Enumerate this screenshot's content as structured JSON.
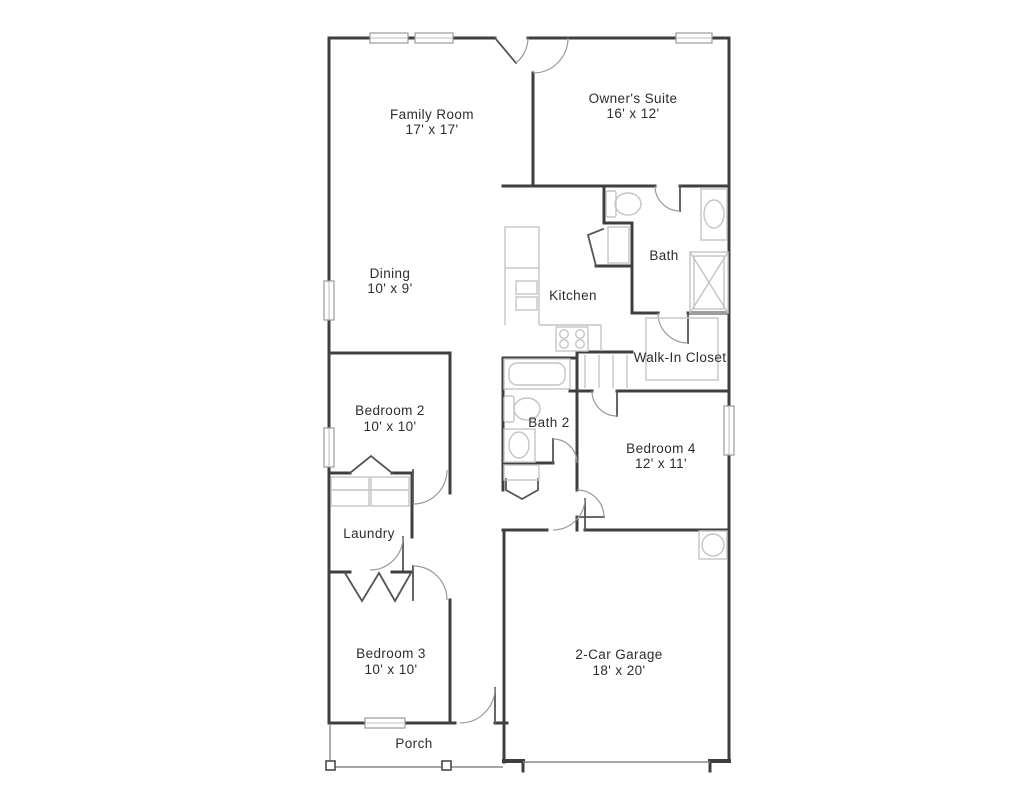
{
  "title": "Floor plan",
  "colors": {
    "background": "#ffffff",
    "wall": "#3f3f3f",
    "fixture": "#c4c4c4",
    "door_arc": "#9a9a9a",
    "text": "#2d2d2d"
  },
  "rooms": [
    {
      "id": "family-room",
      "name": "Family Room",
      "dims": "17' x 17'"
    },
    {
      "id": "owners-suite",
      "name": "Owner's Suite",
      "dims": "16' x 12'"
    },
    {
      "id": "dining",
      "name": "Dining",
      "dims": "10' x 9'"
    },
    {
      "id": "kitchen",
      "name": "Kitchen",
      "dims": ""
    },
    {
      "id": "bath",
      "name": "Bath",
      "dims": ""
    },
    {
      "id": "walk-in-closet",
      "name": "Walk-In Closet",
      "dims": ""
    },
    {
      "id": "bedroom-2",
      "name": "Bedroom 2",
      "dims": "10' x 10'"
    },
    {
      "id": "bath-2",
      "name": "Bath 2",
      "dims": ""
    },
    {
      "id": "bedroom-4",
      "name": "Bedroom 4",
      "dims": "12' x 11'"
    },
    {
      "id": "laundry",
      "name": "Laundry",
      "dims": ""
    },
    {
      "id": "bedroom-3",
      "name": "Bedroom 3",
      "dims": "10' x 10'"
    },
    {
      "id": "garage",
      "name": "2-Car Garage",
      "dims": "18' x 20'"
    },
    {
      "id": "porch",
      "name": "Porch",
      "dims": ""
    }
  ],
  "fixtures": [
    "toilet",
    "vanity-sink",
    "shower",
    "bathtub",
    "kitchen-sink",
    "stove",
    "refrigerator",
    "washer-dryer",
    "water-heater",
    "closet-shelving",
    "porch-posts"
  ]
}
